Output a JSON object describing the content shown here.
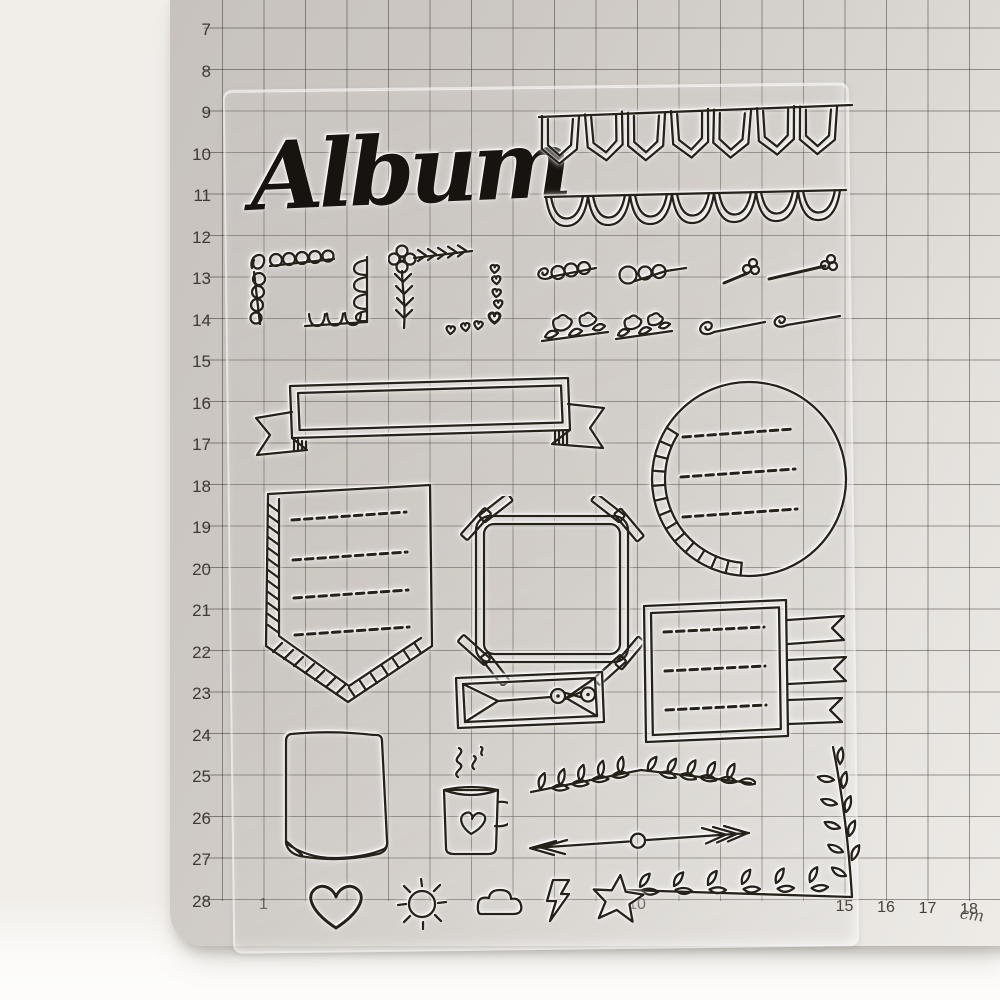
{
  "scene": {
    "type": "product-photo",
    "subject": "clear silicone stamp sheet lying on a centimeter grid cutting mat"
  },
  "mat": {
    "unit_label": "cm",
    "left_ruler": [
      7,
      8,
      9,
      10,
      11,
      12,
      13,
      14,
      15,
      16,
      17,
      18,
      19,
      20,
      21,
      22,
      23,
      24,
      25,
      26,
      27,
      28
    ],
    "bottom_ruler": [
      "1",
      "10",
      "15",
      "16",
      "17",
      "18"
    ],
    "colors": {
      "surface": "#cfcac5",
      "grid_line": "#3e3831",
      "numbers": "#3f3a33"
    }
  },
  "sheet": {
    "title_text": "Album",
    "ink_color": "#262119",
    "material": "transparent",
    "stamps": [
      {
        "name": "album-script-text",
        "text": "Album"
      },
      {
        "name": "bunting-banner",
        "description": "string of 7 pennant flags"
      },
      {
        "name": "scallop-border",
        "description": "scalloped edge border"
      },
      {
        "name": "loop-corner",
        "description": "loop-de-loop corner flourish"
      },
      {
        "name": "scallop-corner",
        "description": "scalloped L corner flourish"
      },
      {
        "name": "flower-arrow-corner",
        "description": "flower corner with feathered arrow and leaf vine"
      },
      {
        "name": "heart-corner",
        "description": "corner flourish of small hearts"
      },
      {
        "name": "loop-swirl-doodle-1",
        "description": "looping swirl line"
      },
      {
        "name": "loop-swirl-doodle-2",
        "description": "looping swirl line"
      },
      {
        "name": "flower-dash-doodle-1",
        "description": "tiny flower on dash line"
      },
      {
        "name": "flower-dash-doodle-2",
        "description": "tiny flower on long dash line"
      },
      {
        "name": "flower-stem-doodle-1",
        "description": "blossoms and leaves on stem"
      },
      {
        "name": "flower-stem-doodle-2",
        "description": "blossoms and leaves on stem"
      },
      {
        "name": "swirl-line-doodle-1",
        "description": "line ending in spiral"
      },
      {
        "name": "swirl-line-doodle-2",
        "description": "line ending in spiral"
      },
      {
        "name": "ribbon-banner-frame",
        "description": "ribbon banner with forked tails"
      },
      {
        "name": "circle-journal-frame",
        "description": "circle frame, hatched edge, 3 dashed writing lines"
      },
      {
        "name": "pennant-shield-frame",
        "description": "pennant frame, hatched edge, 4 dashed writing lines"
      },
      {
        "name": "tape-corners-frame",
        "description": "square frame with washi tape corners"
      },
      {
        "name": "envelope",
        "description": "string-tie envelope"
      },
      {
        "name": "flag-list-frame",
        "description": "square frame, 3 dashed lines ending in swallowtail flags"
      },
      {
        "name": "curled-paper-note",
        "description": "paper sheet with curled bottom edge"
      },
      {
        "name": "coffee-mug",
        "description": "mug with heart and steam"
      },
      {
        "name": "laurel-divider",
        "description": "leafy laurel divider"
      },
      {
        "name": "arrow-divider",
        "description": "double-headed arrow with center circle"
      },
      {
        "name": "laurel-corner-branch",
        "description": "L-shaped leafy branch corner"
      },
      {
        "name": "heart-icon"
      },
      {
        "name": "sun-icon"
      },
      {
        "name": "cloud-icon"
      },
      {
        "name": "lightning-icon"
      },
      {
        "name": "star-icon"
      }
    ]
  }
}
